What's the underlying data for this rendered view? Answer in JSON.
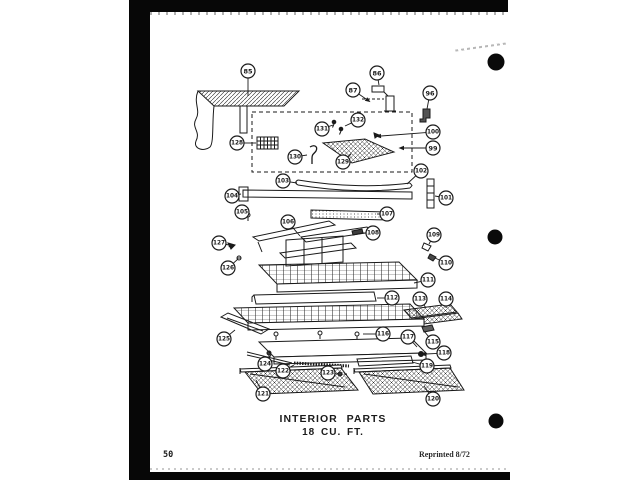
{
  "page": {
    "title_line1": "INTERIOR PARTS",
    "title_line2": "18 CU. FT.",
    "page_number": "50",
    "reprint_note": "Reprinted 8/72",
    "ink_color": "#1a1a1a",
    "paper_color": "#ffffff"
  },
  "diagram": {
    "description_part_numbers": [
      "85",
      "86",
      "87",
      "96",
      "99",
      "100",
      "101",
      "102",
      "103",
      "104",
      "105",
      "106",
      "107",
      "108",
      "109",
      "110",
      "111",
      "112",
      "113",
      "114",
      "115",
      "116",
      "117",
      "118",
      "119",
      "120",
      "121",
      "122",
      "123",
      "124",
      "125",
      "126",
      "127",
      "128",
      "129",
      "130",
      "131",
      "132"
    ],
    "callouts": [
      {
        "n": "85",
        "cx": 248,
        "cy": 71,
        "tx": 248,
        "ty": 96
      },
      {
        "n": "86",
        "cx": 377,
        "cy": 73,
        "tx": 379,
        "ty": 85
      },
      {
        "n": "87",
        "cx": 353,
        "cy": 90,
        "tx": 366,
        "ty": 99,
        "arrow": true
      },
      {
        "n": "96",
        "cx": 430,
        "cy": 93,
        "tx": 427,
        "ty": 109
      },
      {
        "n": "132",
        "cx": 358,
        "cy": 120,
        "tx": 345,
        "ty": 126
      },
      {
        "n": "131",
        "cx": 322,
        "cy": 129,
        "tx": 333,
        "ty": 125
      },
      {
        "n": "100",
        "cx": 433,
        "cy": 132,
        "tx": 381,
        "ty": 136,
        "arrow": true
      },
      {
        "n": "128",
        "cx": 237,
        "cy": 143,
        "tx": 256,
        "ty": 143
      },
      {
        "n": "99",
        "cx": 433,
        "cy": 148,
        "tx": 404,
        "ty": 148,
        "arrow": true
      },
      {
        "n": "130",
        "cx": 295,
        "cy": 157,
        "tx": 307,
        "ty": 155
      },
      {
        "n": "129",
        "cx": 343,
        "cy": 162,
        "tx": 351,
        "ty": 154
      },
      {
        "n": "102",
        "cx": 421,
        "cy": 171,
        "tx": 407,
        "ty": 184
      },
      {
        "n": "103",
        "cx": 283,
        "cy": 181,
        "tx": 297,
        "ty": 183
      },
      {
        "n": "104",
        "cx": 232,
        "cy": 196,
        "tx": 241,
        "ty": 194
      },
      {
        "n": "101",
        "cx": 446,
        "cy": 198,
        "tx": 435,
        "ty": 196
      },
      {
        "n": "105",
        "cx": 242,
        "cy": 212,
        "tx": 247,
        "ty": 214
      },
      {
        "n": "107",
        "cx": 387,
        "cy": 214,
        "tx": 377,
        "ty": 214
      },
      {
        "n": "106",
        "cx": 288,
        "cy": 222,
        "tx": 300,
        "ty": 236
      },
      {
        "n": "108",
        "cx": 373,
        "cy": 233,
        "tx": 362,
        "ty": 233
      },
      {
        "n": "109",
        "cx": 434,
        "cy": 235,
        "tx": 429,
        "ty": 244
      },
      {
        "n": "127",
        "cx": 219,
        "cy": 243,
        "tx": 229,
        "ty": 245,
        "arrow": true
      },
      {
        "n": "110",
        "cx": 446,
        "cy": 263,
        "tx": 435,
        "ty": 258
      },
      {
        "n": "126",
        "cx": 228,
        "cy": 268,
        "tx": 238,
        "ty": 259
      },
      {
        "n": "111",
        "cx": 428,
        "cy": 280,
        "tx": 414,
        "ty": 283
      },
      {
        "n": "112",
        "cx": 392,
        "cy": 298,
        "tx": 377,
        "ty": 298
      },
      {
        "n": "113",
        "cx": 420,
        "cy": 299,
        "tx": 426,
        "ty": 308
      },
      {
        "n": "114",
        "cx": 446,
        "cy": 299,
        "tx": 446,
        "ty": 308
      },
      {
        "n": "125",
        "cx": 224,
        "cy": 339,
        "tx": 235,
        "ty": 330
      },
      {
        "n": "116",
        "cx": 383,
        "cy": 334,
        "tx": 363,
        "ty": 334
      },
      {
        "n": "117",
        "cx": 408,
        "cy": 337,
        "tx": 417,
        "ty": 347
      },
      {
        "n": "115",
        "cx": 433,
        "cy": 342,
        "tx": 424,
        "ty": 331
      },
      {
        "n": "118",
        "cx": 444,
        "cy": 353,
        "tx": 426,
        "ty": 354,
        "arrow": true
      },
      {
        "n": "124",
        "cx": 265,
        "cy": 364,
        "tx": 271,
        "ty": 355
      },
      {
        "n": "119",
        "cx": 427,
        "cy": 366,
        "tx": 412,
        "ty": 362
      },
      {
        "n": "122",
        "cx": 283,
        "cy": 371,
        "tx": 294,
        "ty": 365
      },
      {
        "n": "123",
        "cx": 328,
        "cy": 373,
        "tx": 338,
        "ty": 374
      },
      {
        "n": "121",
        "cx": 263,
        "cy": 394,
        "tx": 256,
        "ty": 380
      },
      {
        "n": "120",
        "cx": 433,
        "cy": 399,
        "tx": 424,
        "ty": 386
      }
    ]
  }
}
